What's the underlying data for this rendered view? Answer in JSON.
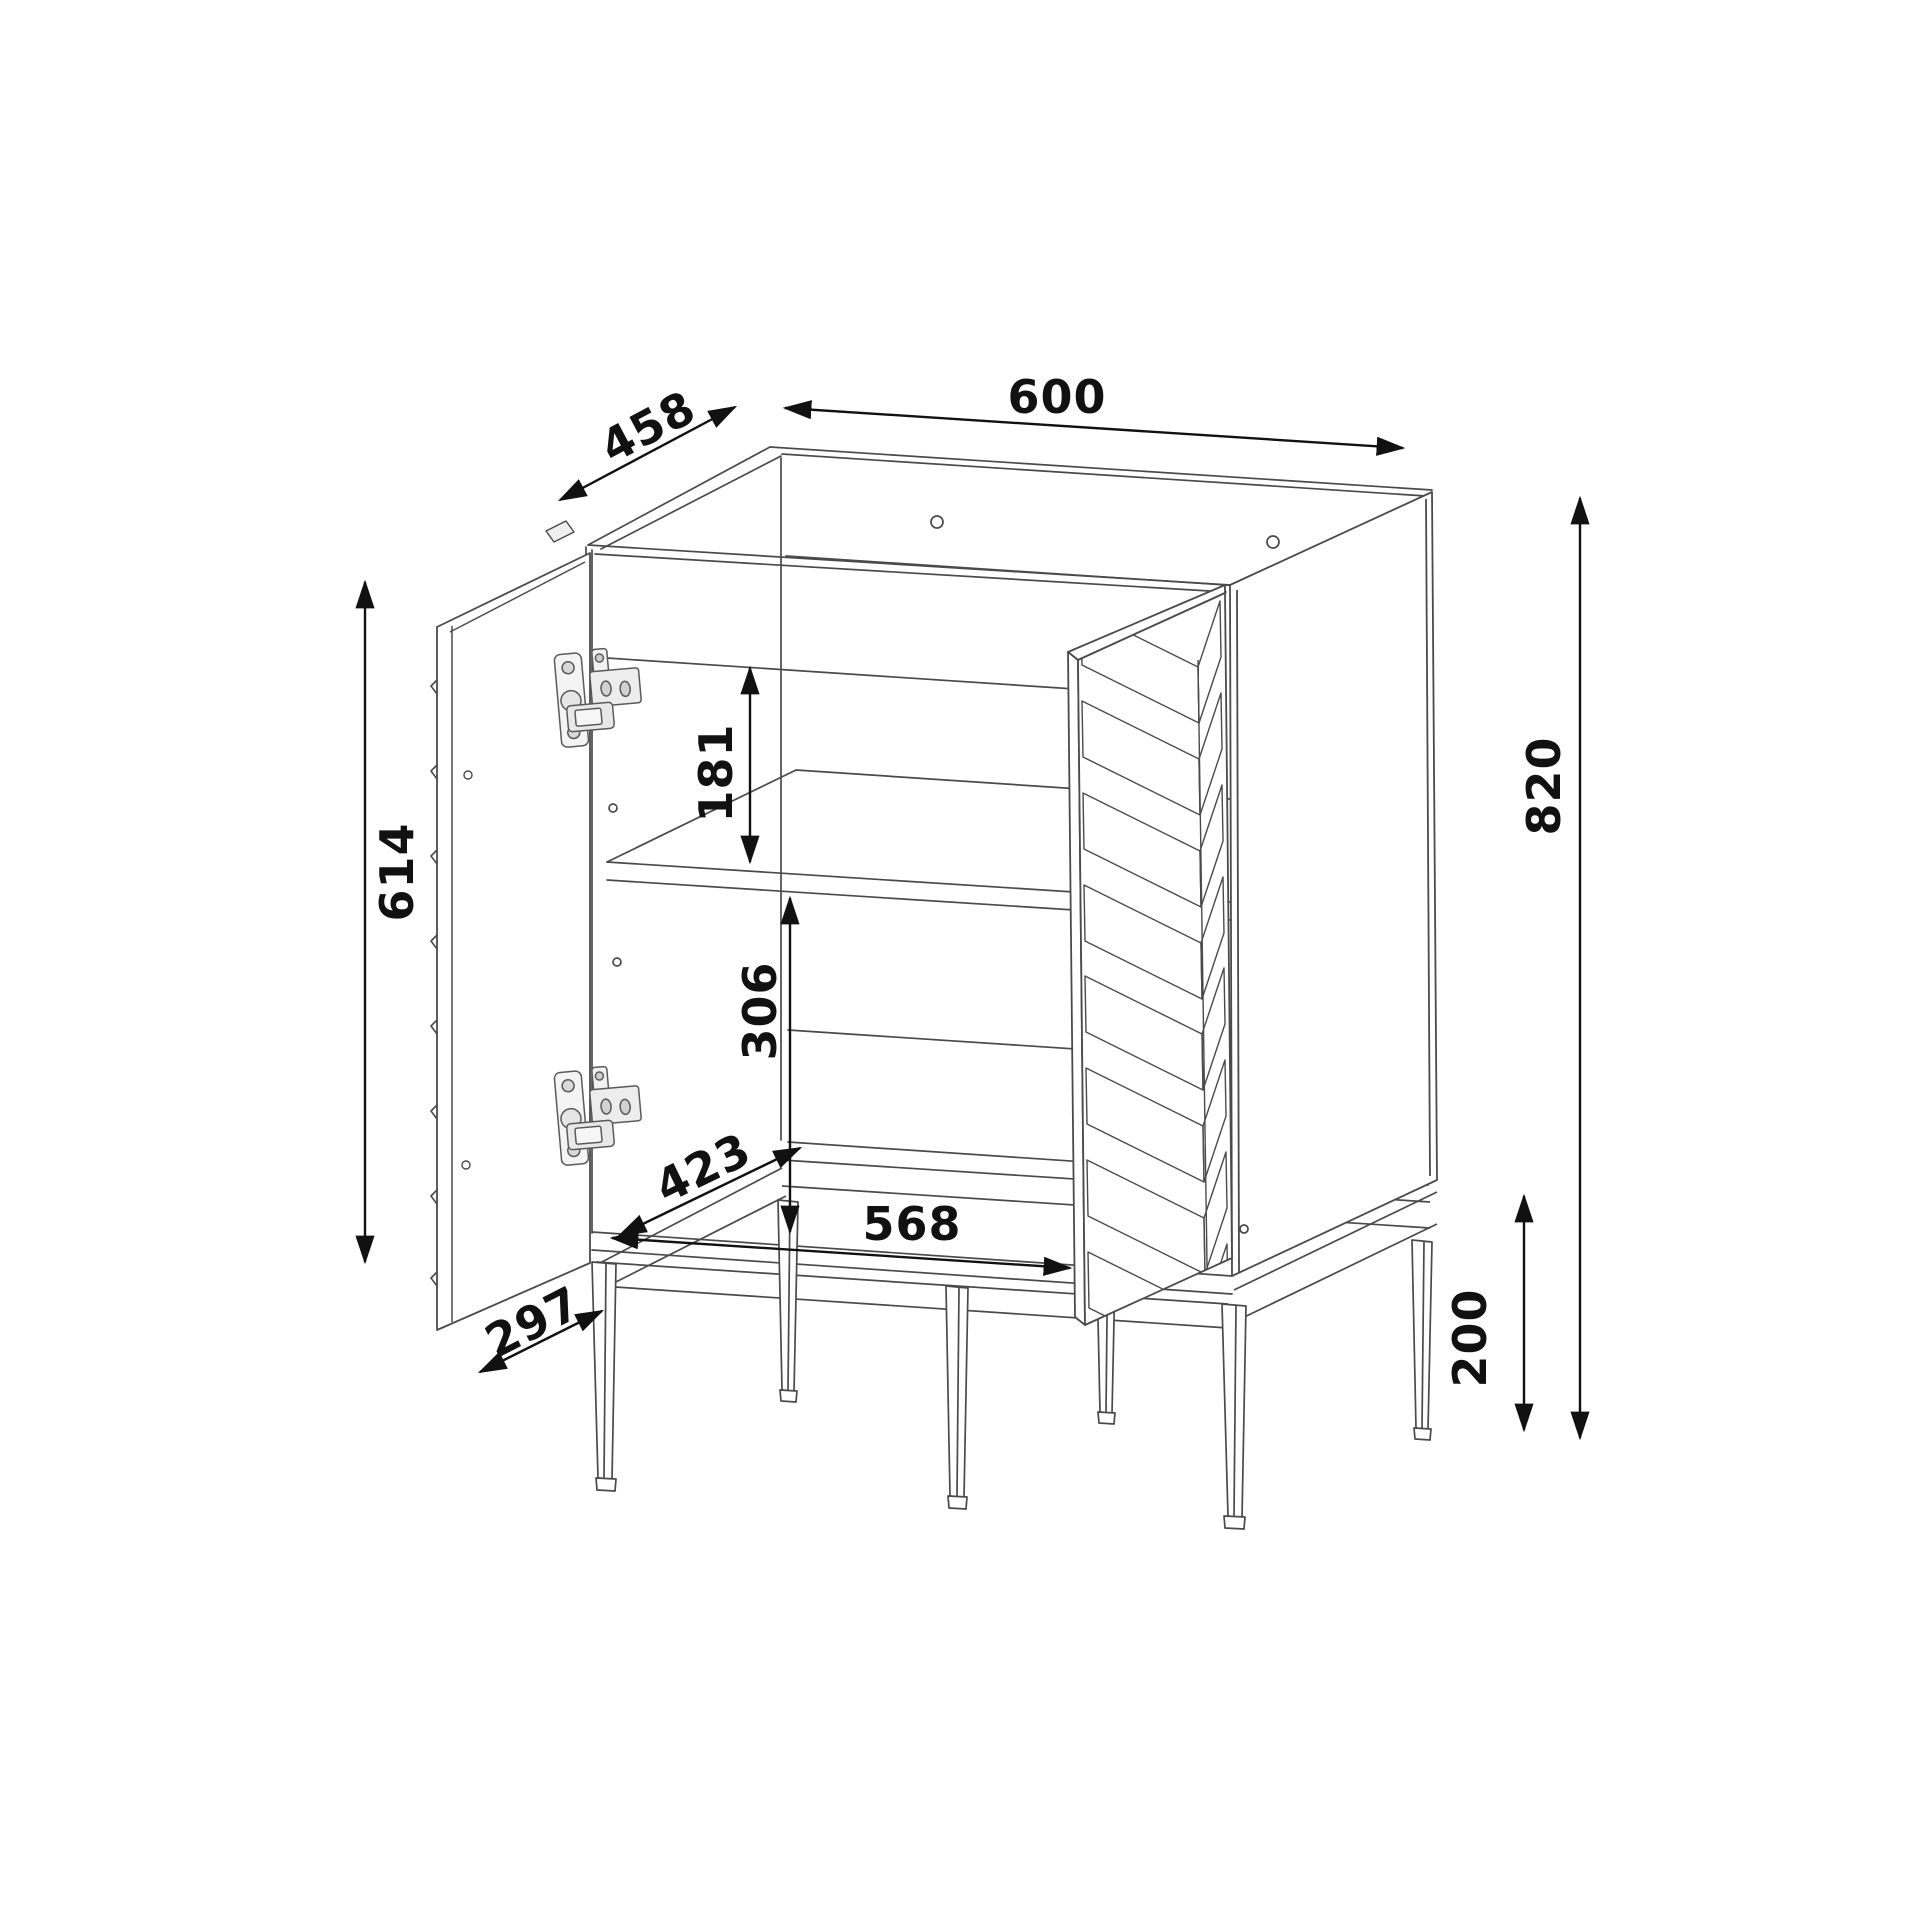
{
  "page": {
    "background": "#ffffff"
  },
  "drawing": {
    "object": "bathroom vanity cabinet technical dimension drawing, two open doors, herringbone front panel, metal frame legs",
    "line_color": "#4a4a4a",
    "dimension_color": "#111111",
    "dims": {
      "width": "600",
      "depth": "458",
      "height": "820",
      "door_height": "614",
      "upper_opening": "181",
      "lower_opening": "306",
      "interior_depth": "423",
      "interior_width": "568",
      "door_width": "297",
      "leg_height": "200"
    }
  }
}
